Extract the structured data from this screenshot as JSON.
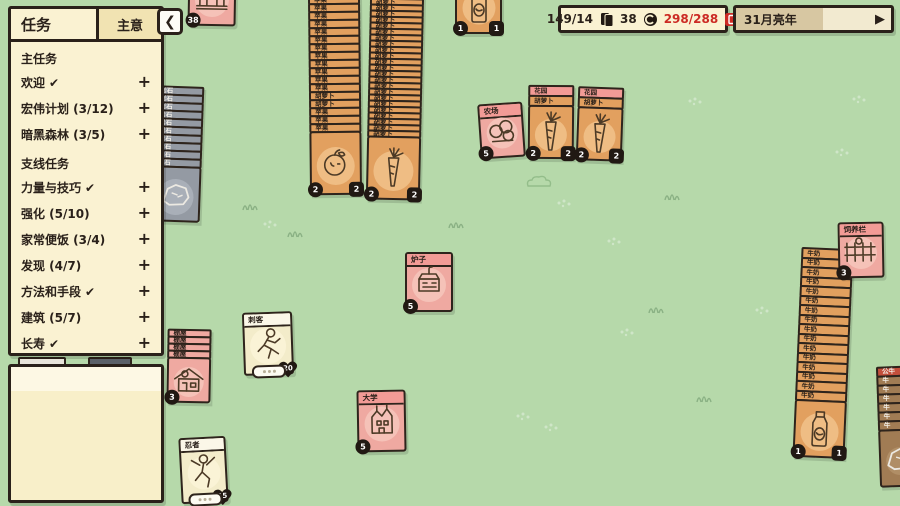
{
  "colors": {
    "bg": "#b6d9aa",
    "ink": "#2a211a",
    "orange": "#e2a05f",
    "orange_halo": "#efbd84",
    "pink": "#efa9a1",
    "pink_header": "#f29b96",
    "pink_halo": "#f5c2b8",
    "cream": "#f3ecca",
    "cream_strip": "#fbf7e8",
    "cream_halo": "#faf3d6",
    "gray": "#949aa3",
    "gray_halo": "#a9afb8",
    "brown": "#a17c54",
    "red_row": "#c34f3c",
    "badge": "#211913",
    "counter_red": "#cc2a24",
    "progress_fill": "#d7c7a2"
  },
  "quest_panel": {
    "title": "任务",
    "tab_label": "主意",
    "collapse_symbol": "❮",
    "check_symbol": "✔",
    "expand_symbol": "+",
    "sections": [
      {
        "header": "主任务",
        "items": [
          {
            "label": "欢迎",
            "checked": true
          },
          {
            "label": "宏伟计划 (3/12)",
            "checked": false
          },
          {
            "label": "暗黑森林 (3/5)",
            "checked": false
          }
        ]
      },
      {
        "header": "支线任务",
        "items": [
          {
            "label": "力量与技巧",
            "checked": true
          },
          {
            "label": "强化 (5/10)",
            "checked": false
          },
          {
            "label": "家常便饭 (3/4)",
            "checked": false
          },
          {
            "label": "发现 (4/7)",
            "checked": false
          },
          {
            "label": "方法和手段",
            "checked": true
          },
          {
            "label": "建筑 (5/7)",
            "checked": false
          },
          {
            "label": "长寿",
            "checked": true
          }
        ]
      }
    ]
  },
  "top_bar": {
    "cards_count": "149/14",
    "coins_count": "38",
    "limit_count": "298/288",
    "date_label": "31月亮年",
    "progress_pct": 56,
    "play_symbol": "▶"
  },
  "board": {
    "stacks": [
      {
        "name": "apple-stack",
        "x": 309,
        "y": -5,
        "rot": -0.6,
        "w": 52,
        "rowH": 10,
        "rows": [
          {
            "l": "苹果",
            "c": "orange"
          },
          {
            "l": "苹果",
            "c": "orange"
          },
          {
            "l": "苹果",
            "c": "orange"
          },
          {
            "l": "苹果",
            "c": "orange"
          },
          {
            "l": "苹果",
            "c": "orange"
          },
          {
            "l": "苹果",
            "c": "orange"
          },
          {
            "l": "苹果",
            "c": "orange"
          },
          {
            "l": "苹果",
            "c": "orange"
          },
          {
            "l": "苹果",
            "c": "orange"
          },
          {
            "l": "苹果",
            "c": "orange"
          },
          {
            "l": "苹果",
            "c": "orange"
          },
          {
            "l": "苹果",
            "c": "orange"
          },
          {
            "l": "胡萝卜",
            "c": "orange"
          },
          {
            "l": "胡萝卜",
            "c": "orange"
          },
          {
            "l": "苹果",
            "c": "orange"
          },
          {
            "l": "苹果",
            "c": "orange"
          },
          {
            "l": "苹果",
            "c": "orange"
          }
        ],
        "body": {
          "c": "orange",
          "h": 64,
          "icon": "apple-icon",
          "bc": "2",
          "bs": "2"
        }
      },
      {
        "name": "carrot-stack",
        "x": 368,
        "y": -8,
        "rot": 1.2,
        "w": 54,
        "rowH": 8,
        "rows": [
          {
            "l": "胡萝卜",
            "c": "orange"
          },
          {
            "l": "胡萝卜",
            "c": "orange"
          },
          {
            "l": "胡萝卜",
            "c": "orange"
          },
          {
            "l": "胡萝卜",
            "c": "orange"
          },
          {
            "l": "胡萝卜",
            "c": "orange"
          },
          {
            "l": "胡萝卜",
            "c": "orange"
          },
          {
            "l": "胡萝卜",
            "c": "orange"
          },
          {
            "l": "胡萝卜",
            "c": "orange"
          },
          {
            "l": "胡萝卜",
            "c": "orange"
          },
          {
            "l": "胡萝卜",
            "c": "orange"
          },
          {
            "l": "胡萝卜",
            "c": "orange"
          },
          {
            "l": "胡萝卜",
            "c": "orange"
          },
          {
            "l": "胡萝卜",
            "c": "orange"
          },
          {
            "l": "胡萝卜",
            "c": "orange"
          },
          {
            "l": "胡萝卜",
            "c": "orange"
          },
          {
            "l": "胡萝卜",
            "c": "orange"
          },
          {
            "l": "胡萝卜",
            "c": "orange"
          },
          {
            "l": "胡萝卜",
            "c": "orange"
          },
          {
            "l": "胡萝卜",
            "c": "orange"
          },
          {
            "l": "胡萝卜",
            "c": "orange"
          },
          {
            "l": "胡萝卜",
            "c": "orange"
          },
          {
            "l": "胡萝卜",
            "c": "orange"
          },
          {
            "l": "胡萝卜",
            "c": "orange"
          },
          {
            "l": "胡萝卜",
            "c": "orange"
          }
        ],
        "body": {
          "c": "orange",
          "h": 64,
          "icon": "carrot-icon",
          "bc": "2",
          "bs": "2"
        }
      },
      {
        "name": "rock-stack",
        "x": 152,
        "y": 86,
        "rot": 2,
        "w": 50,
        "rowH": 10,
        "rows": [
          {
            "l": "岩石",
            "c": "gray"
          },
          {
            "l": "岩石",
            "c": "gray"
          },
          {
            "l": "岩石",
            "c": "gray"
          },
          {
            "l": "岩石",
            "c": "gray"
          },
          {
            "l": "岩石",
            "c": "gray"
          },
          {
            "l": "岩石",
            "c": "gray"
          },
          {
            "l": "岩石",
            "c": "gray"
          },
          {
            "l": "岩石",
            "c": "gray"
          },
          {
            "l": "岩石",
            "c": "gray"
          },
          {
            "l": "岩石",
            "c": "gray"
          }
        ],
        "body": {
          "c": "gray",
          "h": 56,
          "icon": "rock-icon"
        }
      },
      {
        "name": "shed-stack",
        "x": 167,
        "y": 329,
        "rot": 1,
        "w": 44,
        "rowH": 9,
        "rows": [
          {
            "l": "棚屋",
            "c": "pink"
          },
          {
            "l": "棚屋",
            "c": "pink"
          },
          {
            "l": "棚屋",
            "c": "pink"
          },
          {
            "l": "棚屋",
            "c": "pink"
          }
        ],
        "body": {
          "c": "pink",
          "h": 46,
          "icon": "shed-icon",
          "bc": "3"
        }
      },
      {
        "name": "garden-carrot-stack-1",
        "x": 528,
        "y": 85,
        "rot": 0.5,
        "w": 46,
        "rowH": 12,
        "rows": [
          {
            "l": "花园",
            "c": "pink_header"
          },
          {
            "l": "胡萝卜",
            "c": "orange"
          }
        ],
        "body": {
          "c": "orange",
          "h": 54,
          "icon": "carrot-icon",
          "bc": "2",
          "bs": "2"
        }
      },
      {
        "name": "garden-carrot-stack-2",
        "x": 577,
        "y": 87,
        "rot": 2,
        "w": 46,
        "rowH": 12,
        "rows": [
          {
            "l": "花园",
            "c": "pink_header"
          },
          {
            "l": "胡萝卜",
            "c": "orange"
          }
        ],
        "body": {
          "c": "orange",
          "h": 54,
          "icon": "carrot-icon",
          "bc": "2",
          "bs": "2"
        }
      },
      {
        "name": "milk-stack",
        "x": 797,
        "y": 248,
        "rot": 2.5,
        "w": 52,
        "rowH": 11.5,
        "rows": [
          {
            "l": "牛奶",
            "c": "orange"
          },
          {
            "l": "牛奶",
            "c": "orange"
          },
          {
            "l": "牛奶",
            "c": "orange"
          },
          {
            "l": "牛奶",
            "c": "orange"
          },
          {
            "l": "牛奶",
            "c": "orange"
          },
          {
            "l": "牛奶",
            "c": "orange"
          },
          {
            "l": "牛奶",
            "c": "orange"
          },
          {
            "l": "牛奶",
            "c": "orange"
          },
          {
            "l": "牛奶",
            "c": "orange"
          },
          {
            "l": "牛奶",
            "c": "orange"
          },
          {
            "l": "牛奶",
            "c": "orange"
          },
          {
            "l": "牛奶",
            "c": "orange"
          },
          {
            "l": "牛奶",
            "c": "orange"
          },
          {
            "l": "牛奶",
            "c": "orange"
          },
          {
            "l": "牛奶",
            "c": "orange"
          },
          {
            "l": "牛奶",
            "c": "orange"
          }
        ],
        "body": {
          "c": "orange",
          "h": 58,
          "icon": "milk-icon",
          "bc": "1",
          "bs": "1"
        }
      },
      {
        "name": "cow-stack",
        "x": 878,
        "y": 366,
        "rot": -2,
        "w": 42,
        "rowH": 11,
        "rows": [
          {
            "l": "公牛",
            "c": "red_row"
          },
          {
            "l": "牛",
            "c": "brown"
          },
          {
            "l": "牛",
            "c": "brown"
          },
          {
            "l": "牛",
            "c": "brown"
          },
          {
            "l": "牛",
            "c": "brown"
          },
          {
            "l": "牛",
            "c": "brown"
          },
          {
            "l": "牛",
            "c": "brown"
          }
        ],
        "body": {
          "c": "brown",
          "h": 58,
          "icon": "rock-icon"
        }
      }
    ],
    "cards": [
      {
        "name": "treasury-card",
        "x": 188,
        "y": -32,
        "w": 48,
        "h": 58,
        "rot": 1,
        "c": "pink",
        "title": "",
        "icon": "bank-icon",
        "bc": "38"
      },
      {
        "name": "milk-card-top",
        "x": 455,
        "y": -24,
        "w": 47,
        "h": 58,
        "rot": 0,
        "c": "orange",
        "title": "牛奶",
        "icon": "milk-icon",
        "bc": "1",
        "bs": "1"
      },
      {
        "name": "farm-card",
        "x": 479,
        "y": 103,
        "w": 45,
        "h": 55,
        "rot": -4,
        "c": "pink",
        "title": "农场",
        "icon": "farm-icon",
        "bc": "5"
      },
      {
        "name": "breeding-pen-card",
        "x": 838,
        "y": 222,
        "w": 46,
        "h": 56,
        "rot": -1,
        "c": "pink",
        "title": "饲养栏",
        "icon": "pen-icon",
        "bc": "3"
      },
      {
        "name": "stove-card",
        "x": 405,
        "y": 252,
        "w": 48,
        "h": 60,
        "rot": 0,
        "c": "pink",
        "title": "炉子",
        "icon": "stove-icon",
        "bc": "5"
      },
      {
        "name": "assassin-card",
        "x": 243,
        "y": 312,
        "w": 50,
        "h": 63,
        "rot": -2,
        "c": "cream",
        "title": "刺客",
        "icon": "runner-icon",
        "heart": "20",
        "pill": true
      },
      {
        "name": "university-card",
        "x": 357,
        "y": 390,
        "w": 49,
        "h": 62,
        "rot": -1,
        "c": "pink",
        "title": "大学",
        "icon": "university-icon",
        "bc": "5"
      },
      {
        "name": "ninja-card",
        "x": 180,
        "y": 437,
        "w": 47,
        "h": 66,
        "rot": -3,
        "c": "cream",
        "title": "忍者",
        "icon": "ninja-icon",
        "heart": "15",
        "pill": true
      }
    ],
    "slivers": [
      {
        "name": "hidden-card-sliver-light",
        "x": 18,
        "y": 357,
        "w": 44,
        "h": 7,
        "color": "#e8e4da"
      },
      {
        "name": "hidden-card-sliver-dark",
        "x": 88,
        "y": 357,
        "w": 40,
        "h": 7,
        "color": "#5a6068"
      }
    ],
    "decor": [
      {
        "x": 241,
        "y": 196,
        "t": "grass"
      },
      {
        "x": 286,
        "y": 223,
        "t": "grass"
      },
      {
        "x": 647,
        "y": 299,
        "t": "grass"
      },
      {
        "x": 695,
        "y": 388,
        "t": "grass"
      },
      {
        "x": 663,
        "y": 186,
        "t": "grass"
      },
      {
        "x": 447,
        "y": 214,
        "t": "grass"
      },
      {
        "x": 262,
        "y": 214,
        "t": "dots"
      },
      {
        "x": 556,
        "y": 193,
        "t": "dots"
      },
      {
        "x": 606,
        "y": 231,
        "t": "dots"
      },
      {
        "x": 543,
        "y": 417,
        "t": "dots"
      },
      {
        "x": 754,
        "y": 300,
        "t": "dots"
      },
      {
        "x": 834,
        "y": 142,
        "t": "dots"
      },
      {
        "x": 687,
        "y": 91,
        "t": "dots"
      },
      {
        "x": 619,
        "y": 322,
        "t": "dots"
      },
      {
        "x": 515,
        "y": 406,
        "t": "dots"
      },
      {
        "x": 851,
        "y": 89,
        "t": "dots"
      },
      {
        "x": 524,
        "y": 174,
        "t": "bush"
      }
    ]
  }
}
